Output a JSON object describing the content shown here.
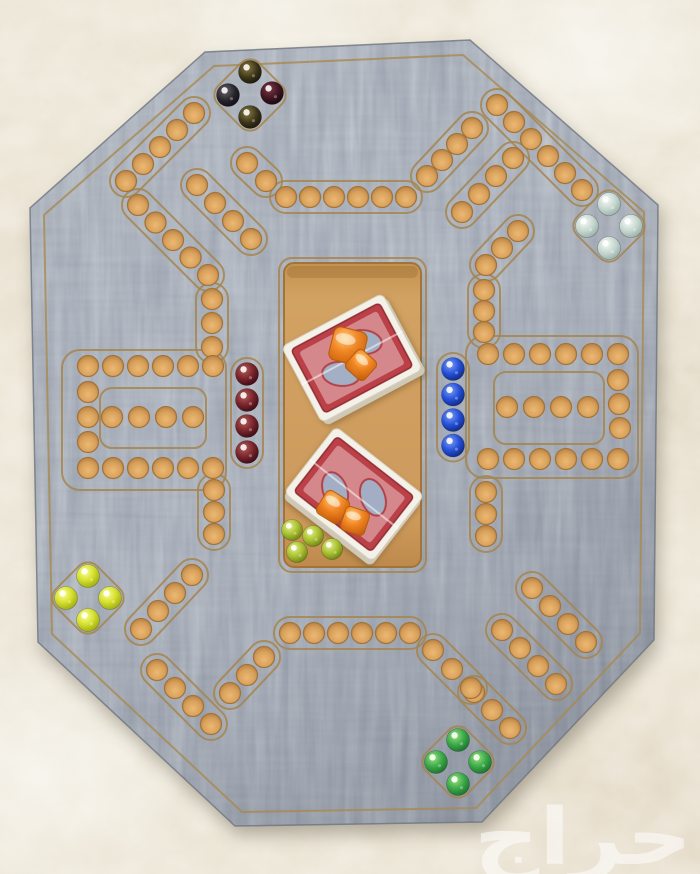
{
  "watermark": {
    "text": "حراج",
    "color": "#ffffff",
    "opacity": 0.55
  },
  "palette": {
    "fabric": "#e9e2d1",
    "board_wood": "#97a0ac",
    "groove": "#a5854e",
    "hole_fill": "#d9a360",
    "hole_rim": "#a3743a",
    "tray_wood": "#cf9c5e",
    "card_back_red": "#bb4046",
    "card_border_white": "#f4f1e8",
    "dice_orange": "#ef7d1c"
  },
  "board": {
    "outline": [
      [
        205,
        52
      ],
      [
        470,
        40
      ],
      [
        658,
        205
      ],
      [
        654,
        640
      ],
      [
        482,
        822
      ],
      [
        235,
        826
      ],
      [
        38,
        642
      ],
      [
        30,
        208
      ]
    ],
    "inset_outline": [
      [
        214,
        66
      ],
      [
        463,
        55
      ],
      [
        644,
        212
      ],
      [
        640,
        633
      ],
      [
        476,
        808
      ],
      [
        242,
        812
      ],
      [
        52,
        634
      ],
      [
        44,
        215
      ]
    ],
    "hole_radius": 10.5,
    "pocket_size": 58,
    "pockets": [
      {
        "id": "top-left",
        "cx": 250,
        "cy": 95
      },
      {
        "id": "top-right",
        "cx": 609,
        "cy": 226
      },
      {
        "id": "bottom-left",
        "cx": 88,
        "cy": 598
      },
      {
        "id": "bottom-right",
        "cx": 458,
        "cy": 762
      }
    ],
    "loops": [
      {
        "id": "left-outer",
        "x": 62,
        "y": 350,
        "w": 164,
        "h": 140,
        "rx": 18
      },
      {
        "id": "left-inner",
        "x": 100,
        "y": 388,
        "w": 106,
        "h": 60,
        "rx": 12
      },
      {
        "id": "right-outer",
        "x": 466,
        "y": 336,
        "w": 172,
        "h": 142,
        "rx": 18
      },
      {
        "id": "right-inner",
        "x": 494,
        "y": 372,
        "w": 110,
        "h": 72,
        "rx": 12
      }
    ],
    "segments": [
      {
        "id": "tl-edge",
        "x": 194,
        "y": 113,
        "dx": -17,
        "dy": 17,
        "n": 5,
        "channel": true
      },
      {
        "id": "tl-return",
        "x": 138,
        "y": 205,
        "dx": 17.5,
        "dy": 17.5,
        "n": 5,
        "channel": true
      },
      {
        "id": "tl-col",
        "x": 212,
        "y": 299,
        "dx": 0,
        "dy": 24,
        "n": 3,
        "channel": true
      },
      {
        "id": "tl-inner",
        "x": 197,
        "y": 185,
        "dx": 18,
        "dy": 18,
        "n": 4,
        "channel": true
      },
      {
        "id": "tl-link",
        "x": 247,
        "y": 163,
        "dx": 19,
        "dy": 18,
        "n": 2,
        "channel": true
      },
      {
        "id": "top-row",
        "x": 286,
        "y": 197,
        "dx": 24,
        "dy": 0,
        "n": 6,
        "channel": true
      },
      {
        "id": "tr-link",
        "x": 427,
        "y": 176,
        "dx": 15,
        "dy": -16,
        "n": 4,
        "channel": true
      },
      {
        "id": "tr-edge",
        "x": 497,
        "y": 105,
        "dx": 17,
        "dy": 17,
        "n": 6,
        "channel": true
      },
      {
        "id": "tr-inner",
        "x": 513,
        "y": 158,
        "dx": -17,
        "dy": 18,
        "n": 4,
        "channel": true
      },
      {
        "id": "tr-return",
        "x": 518,
        "y": 231,
        "dx": -16,
        "dy": 17,
        "n": 3,
        "channel": true
      },
      {
        "id": "tr-col",
        "x": 484,
        "y": 290,
        "dx": 0,
        "dy": 21,
        "n": 3,
        "channel": true
      },
      {
        "id": "right-top-row",
        "x": 488,
        "y": 354,
        "dx": 26,
        "dy": 0,
        "n": 6,
        "channel": false
      },
      {
        "id": "right-side-col",
        "x": 618,
        "y": 380,
        "dx": 1,
        "dy": 24,
        "n": 3,
        "channel": false
      },
      {
        "id": "right-bottom-row",
        "x": 488,
        "y": 459,
        "dx": 26,
        "dy": 0,
        "n": 6,
        "channel": false
      },
      {
        "id": "right-home-row",
        "x": 507,
        "y": 407,
        "dx": 27,
        "dy": 0,
        "n": 4,
        "channel": false
      },
      {
        "id": "right-start-col",
        "x": 453,
        "y": 369,
        "dx": 0,
        "dy": 25.5,
        "n": 4,
        "channel": true
      },
      {
        "id": "br-col",
        "x": 486,
        "y": 492,
        "dx": 0,
        "dy": 22,
        "n": 3,
        "channel": true
      },
      {
        "id": "br-d1",
        "x": 532,
        "y": 588,
        "dx": 18,
        "dy": 18,
        "n": 4,
        "channel": true
      },
      {
        "id": "br-d2",
        "x": 502,
        "y": 630,
        "dx": 18,
        "dy": 18,
        "n": 4,
        "channel": true
      },
      {
        "id": "br-d3",
        "x": 474,
        "y": 692,
        "dx": 18,
        "dy": 18,
        "n": 3,
        "channel": true
      },
      {
        "id": "bottom-link-right",
        "x": 433,
        "y": 650,
        "dx": 19,
        "dy": 19,
        "n": 3,
        "channel": true
      },
      {
        "id": "bottom-row",
        "x": 290,
        "y": 633,
        "dx": 24,
        "dy": 0,
        "n": 6,
        "channel": true
      },
      {
        "id": "bottom-link-left",
        "x": 264,
        "y": 657,
        "dx": -17,
        "dy": 18,
        "n": 3,
        "channel": true
      },
      {
        "id": "bl-e2",
        "x": 157,
        "y": 670,
        "dx": 18,
        "dy": 18,
        "n": 4,
        "channel": true
      },
      {
        "id": "bl-e1",
        "x": 192,
        "y": 575,
        "dx": -17,
        "dy": 18,
        "n": 4,
        "channel": true
      },
      {
        "id": "bl-col",
        "x": 214,
        "y": 490,
        "dx": 0,
        "dy": 22,
        "n": 3,
        "channel": true
      },
      {
        "id": "left-top-row",
        "x": 88,
        "y": 366,
        "dx": 25,
        "dy": 0,
        "n": 6,
        "channel": false
      },
      {
        "id": "left-side-col",
        "x": 88,
        "y": 392,
        "dx": 0,
        "dy": 25,
        "n": 3,
        "channel": false
      },
      {
        "id": "left-bottom-row",
        "x": 88,
        "y": 468,
        "dx": 25,
        "dy": 0,
        "n": 6,
        "channel": false
      },
      {
        "id": "left-home-row",
        "x": 112,
        "y": 417,
        "dx": 27,
        "dy": 0,
        "n": 4,
        "channel": false
      },
      {
        "id": "left-start-col",
        "x": 247,
        "y": 374,
        "dx": 0,
        "dy": 26,
        "n": 4,
        "channel": true
      }
    ]
  },
  "tray": {
    "x": 284,
    "y": 263,
    "w": 137,
    "h": 304,
    "rx": 10,
    "decks": [
      {
        "id": "deck-upper",
        "cx": 352,
        "cy": 358,
        "w": 114,
        "h": 86,
        "angle": -28
      },
      {
        "id": "deck-lower",
        "cx": 354,
        "cy": 494,
        "w": 112,
        "h": 84,
        "angle": 38
      }
    ],
    "dice": [
      {
        "cx": 348,
        "cy": 346,
        "size": 34,
        "angle": 14
      },
      {
        "cx": 361,
        "cy": 365,
        "size": 25,
        "angle": 42
      },
      {
        "cx": 333,
        "cy": 507,
        "size": 27,
        "angle": 32
      },
      {
        "cx": 355,
        "cy": 521,
        "size": 25,
        "angle": 18
      }
    ],
    "marbles": [
      {
        "cx": 292,
        "cy": 530
      },
      {
        "cx": 313,
        "cy": 536
      },
      {
        "cx": 297,
        "cy": 552
      },
      {
        "cx": 332,
        "cy": 549
      }
    ],
    "marble_color": "lime"
  },
  "marbles": {
    "radius": 11.5,
    "groups": [
      {
        "id": "dark-set",
        "location": "top-left-pocket",
        "items": [
          {
            "cx": 250,
            "cy": 72,
            "color": "dark-olive"
          },
          {
            "cx": 228,
            "cy": 95,
            "color": "black"
          },
          {
            "cx": 272,
            "cy": 93,
            "color": "dark-red"
          },
          {
            "cx": 250,
            "cy": 117,
            "color": "dark-olive"
          }
        ]
      },
      {
        "id": "pale-blue-set",
        "location": "top-right-pocket",
        "items": [
          {
            "cx": 609,
            "cy": 204,
            "color": "pale-blue"
          },
          {
            "cx": 587,
            "cy": 226,
            "color": "pale-blue"
          },
          {
            "cx": 631,
            "cy": 226,
            "color": "pale-blue"
          },
          {
            "cx": 609,
            "cy": 248,
            "color": "pale-blue"
          }
        ]
      },
      {
        "id": "blue-set",
        "location": "right-start-column",
        "items": [
          {
            "cx": 453,
            "cy": 369,
            "color": "blue"
          },
          {
            "cx": 453,
            "cy": 394.5,
            "color": "blue"
          },
          {
            "cx": 453,
            "cy": 420,
            "color": "blue"
          },
          {
            "cx": 453,
            "cy": 445.5,
            "color": "blue"
          }
        ]
      },
      {
        "id": "maroon-set",
        "location": "left-start-column",
        "items": [
          {
            "cx": 247,
            "cy": 374,
            "color": "maroon"
          },
          {
            "cx": 247,
            "cy": 400,
            "color": "maroon"
          },
          {
            "cx": 247,
            "cy": 426,
            "color": "maroon"
          },
          {
            "cx": 247,
            "cy": 452,
            "color": "maroon"
          }
        ]
      },
      {
        "id": "yellow-set",
        "location": "bottom-left-pocket",
        "items": [
          {
            "cx": 88,
            "cy": 576,
            "color": "yellow"
          },
          {
            "cx": 66,
            "cy": 598,
            "color": "yellow"
          },
          {
            "cx": 110,
            "cy": 598,
            "color": "yellow"
          },
          {
            "cx": 88,
            "cy": 620,
            "color": "yellow"
          }
        ]
      },
      {
        "id": "green-set",
        "location": "bottom-right-pocket",
        "items": [
          {
            "cx": 458,
            "cy": 740,
            "color": "green"
          },
          {
            "cx": 436,
            "cy": 762,
            "color": "green"
          },
          {
            "cx": 480,
            "cy": 762,
            "color": "green"
          },
          {
            "cx": 458,
            "cy": 784,
            "color": "green"
          }
        ]
      }
    ]
  }
}
